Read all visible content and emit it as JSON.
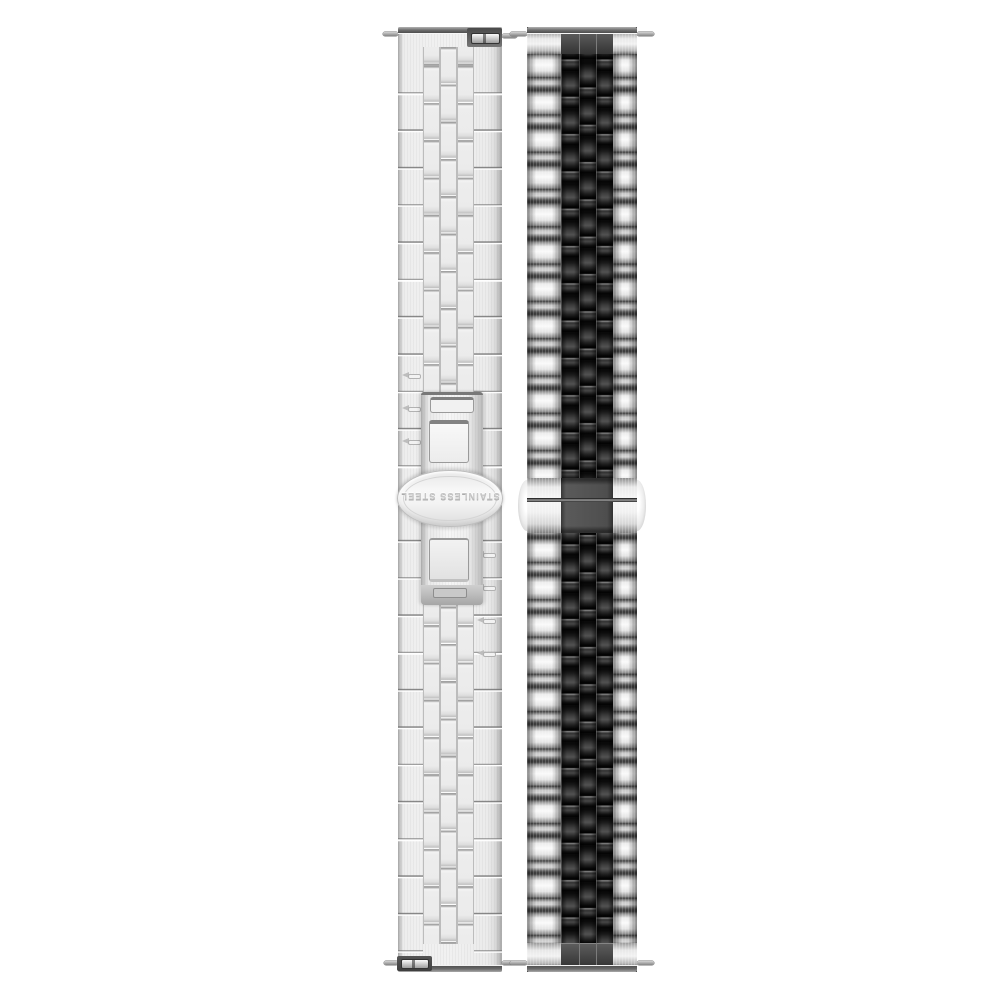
{
  "left_band": {
    "clasp_engraving": "STAINLESS STEEL"
  },
  "colors": {
    "page_background": "#ffffff",
    "silver_highlight": "#fafafa",
    "silver_mid": "#d9d9d9",
    "silver_shadow": "#5f5f5f",
    "steel_dark": "#3f3f3f",
    "black_link": "#0a0a0a",
    "black_link_highlight": "#525252",
    "clasp_center_gray": "#4e4e4e",
    "back_plate_light": "#ededed",
    "seam_gray": "#a0a0a0",
    "engraving_gray": "#c6c6c6"
  }
}
